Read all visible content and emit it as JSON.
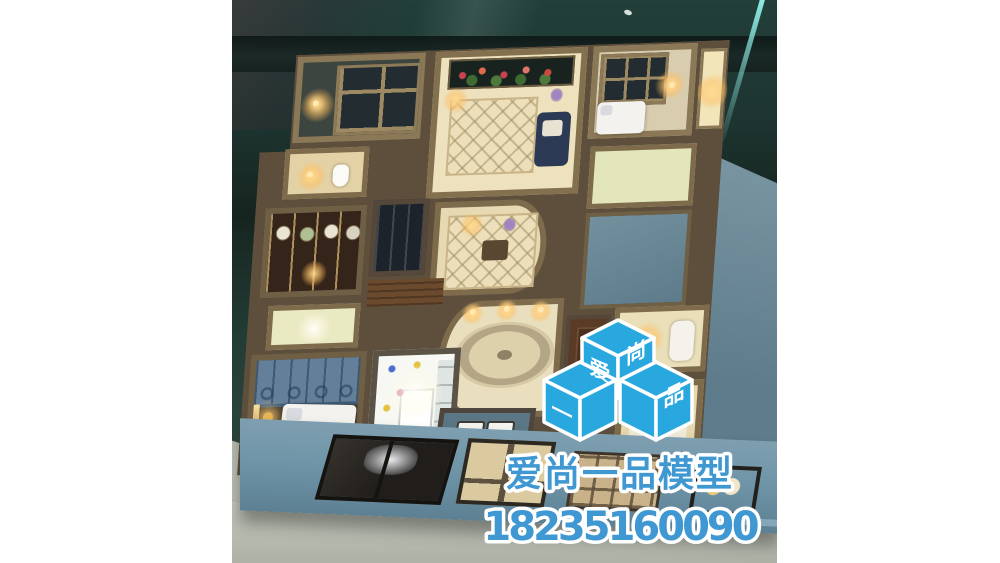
{
  "image": {
    "alt": "Illuminated interior architectural scale model of an apartment floor plan, photographed from above inside a dark glass display case"
  },
  "watermark": {
    "logo": {
      "name": "aishang-yipin-cube-logo",
      "cubes": [
        {
          "position": "top-cube-left-face",
          "label": "爱"
        },
        {
          "position": "top-cube-right-face",
          "label": "尚"
        },
        {
          "position": "bottom-left-cube-left-face",
          "label": "一"
        },
        {
          "position": "bottom-right-cube-right-face",
          "label": "品"
        }
      ],
      "colors": {
        "cube_fill": "#29a8e0",
        "outline": "#ffffff",
        "glyph": "#ffffff"
      }
    },
    "title": "爱尚一品模型",
    "phone": "18235160090",
    "colors": {
      "text_fill": "#3f98d2",
      "text_outline": "#ffffff"
    }
  },
  "palette": {
    "page_background": "#ffffff",
    "glass_teal": "#21403b",
    "marble_band": "#121d1b",
    "wall_top_tan": "#7d6b50",
    "warm_floor": "#e7dab2",
    "light_glow": "#ffd98e",
    "facade_blue": "#7095a8",
    "wardrobe_blue": "#647f99",
    "table_gray": "#b7bbb0",
    "glass_edge_cyan": "#8feee6"
  }
}
